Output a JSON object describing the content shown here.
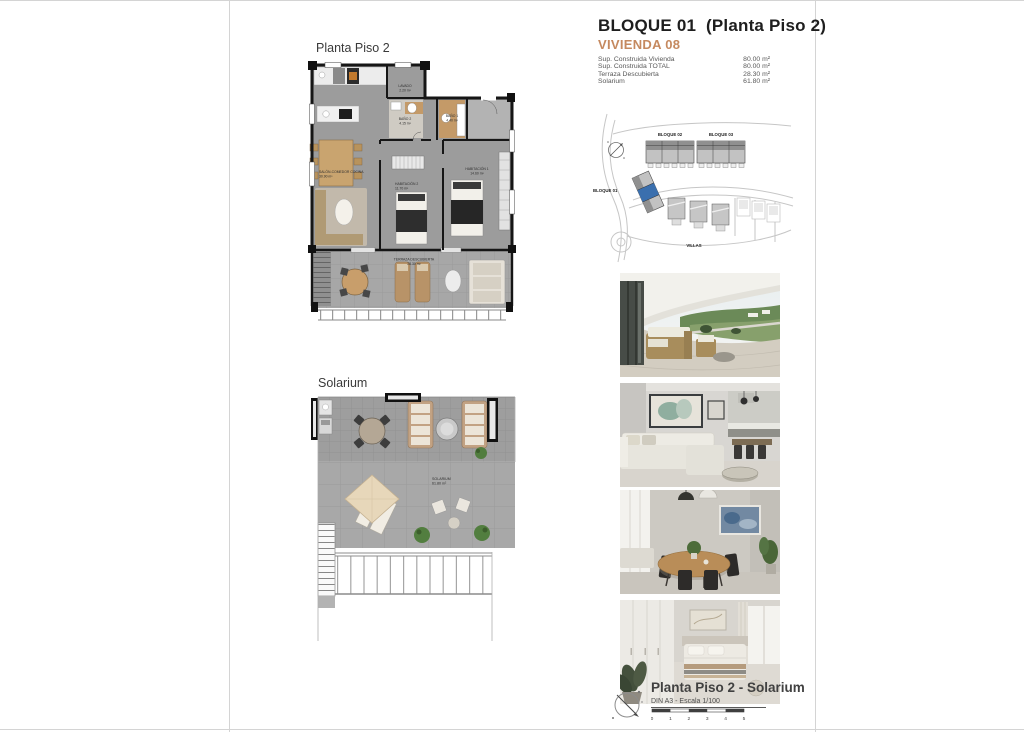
{
  "page": {
    "bg": "#ffffff",
    "edge_color": "#d4d4d4"
  },
  "header": {
    "title": "BLOQUE 01  (Planta Piso 2)",
    "subtitle": "VIVIENDA 08",
    "accent_color": "#c5895f",
    "specs": [
      {
        "label": "Sup. Construida Vivienda",
        "value": "80.00 m²"
      },
      {
        "label": "Sup. Construida TOTAL",
        "value": "80.00 m²"
      },
      {
        "label": "Terraza Descubierta",
        "value": "28.30 m²"
      },
      {
        "label": "Solarium",
        "value": "61.80 m²"
      }
    ]
  },
  "plan1": {
    "title": "Planta Piso 2",
    "rooms": {
      "lavado": {
        "name": "LAVADO",
        "area": "2.20 m²"
      },
      "bano2": {
        "name": "BAÑO 2",
        "area": "4.15 m²"
      },
      "bano1": {
        "name": "BAÑO 1",
        "area": "4.40 m²"
      },
      "hab1": {
        "name": "HABITACIÓN 1",
        "area": "14.60 m²"
      },
      "hab2": {
        "name": "HABITACIÓN 2",
        "area": "11.70 m²"
      },
      "salon": {
        "name": "SALÓN-COMEDOR COCINA",
        "area": "30.90 m²"
      },
      "terraza": {
        "name": "TERRAZA DESCUBIERTA",
        "area": "28.30 m²"
      }
    }
  },
  "plan2": {
    "title": "Solarium",
    "rooms": {
      "solarium": {
        "name": "SOLARIUM",
        "area": "61.80 m²"
      }
    }
  },
  "site_map": {
    "labels": {
      "bloque02": "BLOQUE 02",
      "bloque03": "BLOQUE 03",
      "bloque01": "BLOQUE 01",
      "villas": "VILLAS"
    },
    "highlight_color": "#3a6fae"
  },
  "photos": [
    {
      "name": "terrace-balcony-render"
    },
    {
      "name": "living-room-render"
    },
    {
      "name": "dining-area-render"
    },
    {
      "name": "bedroom-render"
    }
  ],
  "footer": {
    "title": "Planta Piso 2 - Solarium",
    "scale_note": "DIN A3 - Escala 1/100",
    "scale_ticks": [
      "0",
      "1",
      "2",
      "3",
      "4",
      "5"
    ]
  }
}
